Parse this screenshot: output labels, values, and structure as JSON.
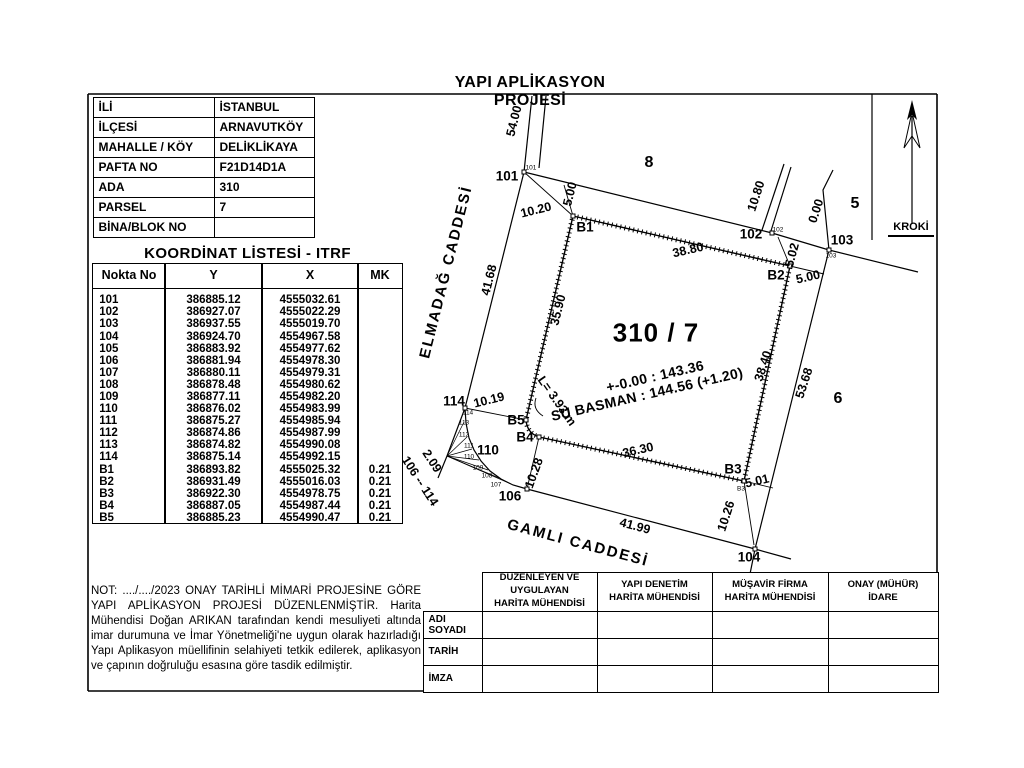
{
  "title": "YAPI APLİKASYON PROJESİ",
  "kroki_label": "KROKİ",
  "info_table": {
    "rows": [
      {
        "label": "İLİ",
        "value": "İSTANBUL"
      },
      {
        "label": "İLÇESİ",
        "value": "ARNAVUTKÖY"
      },
      {
        "label": "MAHALLE / KÖY",
        "value": "DELİKLİKAYA"
      },
      {
        "label": "PAFTA NO",
        "value": "F21D14D1A"
      },
      {
        "label": "ADA",
        "value": "310"
      },
      {
        "label": "PARSEL",
        "value": "7"
      },
      {
        "label": "BİNA/BLOK NO",
        "value": ""
      }
    ]
  },
  "coord_table": {
    "title": "KOORDİNAT LİSTESİ - ITRF",
    "headers": [
      "Nokta No",
      "Y",
      "X",
      "MK"
    ],
    "rows": [
      {
        "no": "101",
        "y": "386885.12",
        "x": "4555032.61",
        "mk": ""
      },
      {
        "no": "102",
        "y": "386927.07",
        "x": "4555022.29",
        "mk": ""
      },
      {
        "no": "103",
        "y": "386937.55",
        "x": "4555019.70",
        "mk": ""
      },
      {
        "no": "104",
        "y": "386924.70",
        "x": "4554967.58",
        "mk": ""
      },
      {
        "no": "105",
        "y": "386883.92",
        "x": "4554977.62",
        "mk": ""
      },
      {
        "no": "106",
        "y": "386881.94",
        "x": "4554978.30",
        "mk": ""
      },
      {
        "no": "107",
        "y": "386880.11",
        "x": "4554979.31",
        "mk": ""
      },
      {
        "no": "108",
        "y": "386878.48",
        "x": "4554980.62",
        "mk": ""
      },
      {
        "no": "109",
        "y": "386877.11",
        "x": "4554982.20",
        "mk": ""
      },
      {
        "no": "110",
        "y": "386876.02",
        "x": "4554983.99",
        "mk": ""
      },
      {
        "no": "111",
        "y": "386875.27",
        "x": "4554985.94",
        "mk": ""
      },
      {
        "no": "112",
        "y": "386874.86",
        "x": "4554987.99",
        "mk": ""
      },
      {
        "no": "113",
        "y": "386874.82",
        "x": "4554990.08",
        "mk": ""
      },
      {
        "no": "114",
        "y": "386875.14",
        "x": "4554992.15",
        "mk": ""
      },
      {
        "no": "B1",
        "y": "386893.82",
        "x": "4555025.32",
        "mk": "0.21"
      },
      {
        "no": "B2",
        "y": "386931.49",
        "x": "4555016.03",
        "mk": "0.21"
      },
      {
        "no": "B3",
        "y": "386922.30",
        "x": "4554978.75",
        "mk": "0.21"
      },
      {
        "no": "B4",
        "y": "386887.05",
        "x": "4554987.44",
        "mk": "0.21"
      },
      {
        "no": "B5",
        "y": "386885.23",
        "x": "4554990.47",
        "mk": "0.21"
      }
    ]
  },
  "note": "NOT: ..../..../2023 ONAY TARİHLİ MİMARİ PROJESİNE GÖRE YAPI APLİKASYON PROJESİ DÜZENLENMİŞTİR. Harita Mühendisi Doğan ARIKAN tarafından kendi mesuliyeti altında imar durumuna ve İmar Yönetmeliği'ne uygun olarak hazırladığı Yapı Aplikasyon müellifinin selahiyeti tetkik edilerek, aplikasyon ve çapının doğruluğu esasına göre tasdik edilmiştir.",
  "signature_table": {
    "column_headers": [
      "DÜZENLEYEN VE\nUYGULAYAN\nHARİTA MÜHENDİSİ",
      "YAPI DENETİM\nHARİTA MÜHENDİSİ",
      "MÜŞAVİR FİRMA\nHARİTA MÜHENDİSİ",
      "ONAY (MÜHÜR)\nİDARE"
    ],
    "row_labels": [
      "ADI SOYADI",
      "TARİH",
      "İMZA"
    ]
  },
  "drawing": {
    "parcel_number": "310 / 7",
    "elevation_note": "+-0.00 : 143.36",
    "basement_note": "SU BASMAN : 144.56 (+1.20)",
    "streets": [
      "ELMADAĞ CADDESİ",
      "GAMLI CADDESİ"
    ],
    "neighbor_parcels": [
      "8",
      "5",
      "6"
    ],
    "labels": [
      {
        "name": "street-elmadag",
        "text": "ELMADAĞ CADDESİ",
        "x": 446,
        "y": 272,
        "rot": -76,
        "cls": "street"
      },
      {
        "name": "street-gamli",
        "text": "GAMLI CADDESİ",
        "x": 578,
        "y": 543,
        "rot": 15,
        "cls": "street"
      },
      {
        "name": "parcel-title",
        "text": "310 / 7",
        "x": 656,
        "y": 333,
        "rot": 0,
        "cls": "parcel"
      },
      {
        "name": "elevation-note",
        "text": "+-0.00 : 143.36",
        "x": 655,
        "y": 376,
        "rot": -13,
        "cls": "note-big"
      },
      {
        "name": "basement-note",
        "text": "SU BASMAN : 144.56 (+1.20)",
        "x": 647,
        "y": 394,
        "rot": -13,
        "cls": "note-big"
      },
      {
        "name": "neighbor-parcel-8",
        "text": "8",
        "x": 649,
        "y": 163,
        "rot": 0,
        "cls": "neighbor"
      },
      {
        "name": "neighbor-parcel-5",
        "text": "5",
        "x": 855,
        "y": 204,
        "rot": 0,
        "cls": "neighbor"
      },
      {
        "name": "neighbor-parcel-6",
        "text": "6",
        "x": 838,
        "y": 399,
        "rot": 0,
        "cls": "neighbor"
      },
      {
        "name": "point-101",
        "text": "101",
        "x": 507,
        "y": 176,
        "rot": 0,
        "cls": "pt"
      },
      {
        "name": "point-102",
        "text": "102",
        "x": 751,
        "y": 234,
        "rot": 0,
        "cls": "pt"
      },
      {
        "name": "point-103",
        "text": "103",
        "x": 842,
        "y": 240,
        "rot": 0,
        "cls": "pt"
      },
      {
        "name": "point-104",
        "text": "104",
        "x": 749,
        "y": 557,
        "rot": 0,
        "cls": "pt"
      },
      {
        "name": "point-106",
        "text": "106",
        "x": 510,
        "y": 496,
        "rot": 0,
        "cls": "pt"
      },
      {
        "name": "point-110",
        "text": "110",
        "x": 488,
        "y": 450,
        "rot": 0,
        "cls": "pt"
      },
      {
        "name": "point-114",
        "text": "114",
        "x": 454,
        "y": 401,
        "rot": 0,
        "cls": "pt"
      },
      {
        "name": "point-B1",
        "text": "B1",
        "x": 585,
        "y": 227,
        "rot": 0,
        "cls": "pt"
      },
      {
        "name": "point-B2",
        "text": "B2",
        "x": 776,
        "y": 275,
        "rot": 0,
        "cls": "pt"
      },
      {
        "name": "point-B3",
        "text": "B3",
        "x": 733,
        "y": 469,
        "rot": 0,
        "cls": "pt"
      },
      {
        "name": "point-B4",
        "text": "B4",
        "x": 525,
        "y": 437,
        "rot": 0,
        "cls": "pt"
      },
      {
        "name": "point-B5",
        "text": "B5",
        "x": 516,
        "y": 420,
        "rot": 0,
        "cls": "pt"
      },
      {
        "name": "dim-54-00",
        "text": "54.00",
        "x": 514,
        "y": 121,
        "rot": -76,
        "cls": "dim"
      },
      {
        "name": "dim-10-20",
        "text": "10.20",
        "x": 536,
        "y": 210,
        "rot": -14,
        "cls": "dim"
      },
      {
        "name": "dim-5-00-b1",
        "text": "5.00",
        "x": 570,
        "y": 194,
        "rot": -76,
        "cls": "dim"
      },
      {
        "name": "dim-38-80",
        "text": "38.80",
        "x": 688,
        "y": 250,
        "rot": -13,
        "cls": "dim"
      },
      {
        "name": "dim-10-80",
        "text": "10.80",
        "x": 756,
        "y": 196,
        "rot": -72,
        "cls": "dim"
      },
      {
        "name": "dim-0-00",
        "text": "0.00",
        "x": 816,
        "y": 211,
        "rot": -72,
        "cls": "dim"
      },
      {
        "name": "dim-5-02",
        "text": "5.02",
        "x": 792,
        "y": 255,
        "rot": -75,
        "cls": "dim"
      },
      {
        "name": "dim-5-00-b2",
        "text": "5.00",
        "x": 808,
        "y": 277,
        "rot": -13,
        "cls": "dim"
      },
      {
        "name": "dim-41-68",
        "text": "41.68",
        "x": 489,
        "y": 280,
        "rot": -76,
        "cls": "dim"
      },
      {
        "name": "dim-35-90",
        "text": "35.90",
        "x": 558,
        "y": 310,
        "rot": -76,
        "cls": "dim"
      },
      {
        "name": "dim-38-40",
        "text": "38.40",
        "x": 763,
        "y": 366,
        "rot": -72,
        "cls": "dim"
      },
      {
        "name": "dim-53-68",
        "text": "53.68",
        "x": 804,
        "y": 383,
        "rot": -72,
        "cls": "dim"
      },
      {
        "name": "dim-10-19",
        "text": "10.19",
        "x": 489,
        "y": 400,
        "rot": -14,
        "cls": "dim"
      },
      {
        "name": "dim-36-30",
        "text": "36.30",
        "x": 638,
        "y": 450,
        "rot": -13,
        "cls": "dim"
      },
      {
        "name": "dim-5-01",
        "text": "5.01",
        "x": 757,
        "y": 481,
        "rot": -13,
        "cls": "dim"
      },
      {
        "name": "dim-10-26",
        "text": "10.26",
        "x": 726,
        "y": 516,
        "rot": -72,
        "cls": "dim"
      },
      {
        "name": "dim-10-28",
        "text": "10.28",
        "x": 534,
        "y": 473,
        "rot": -70,
        "cls": "dim"
      },
      {
        "name": "dim-41-99",
        "text": "41.99",
        "x": 635,
        "y": 526,
        "rot": 15,
        "cls": "dim"
      },
      {
        "name": "dim-2-09",
        "text": "2.09",
        "x": 432,
        "y": 461,
        "rot": 57,
        "cls": "dim"
      },
      {
        "name": "dim-range-106-114",
        "text": "106 -- 114",
        "x": 420,
        "y": 481,
        "rot": 57,
        "cls": "dim"
      },
      {
        "name": "dim-arc-length",
        "text": "L= 3.93 m",
        "x": 557,
        "y": 401,
        "rot": 55,
        "cls": "dim"
      },
      {
        "name": "tiny-114",
        "text": "114",
        "x": 468,
        "y": 413,
        "rot": 0,
        "cls": "tiny"
      },
      {
        "name": "tiny-113",
        "text": "113",
        "x": 464,
        "y": 423,
        "rot": 0,
        "cls": "tiny"
      },
      {
        "name": "tiny-112",
        "text": "112",
        "x": 464,
        "y": 435,
        "rot": 0,
        "cls": "tiny"
      },
      {
        "name": "tiny-111",
        "text": "111",
        "x": 469,
        "y": 446,
        "rot": 0,
        "cls": "tiny"
      },
      {
        "name": "tiny-110",
        "text": "110",
        "x": 469,
        "y": 457,
        "rot": 0,
        "cls": "tiny"
      },
      {
        "name": "tiny-109",
        "text": "109",
        "x": 478,
        "y": 468,
        "rot": 0,
        "cls": "tiny"
      },
      {
        "name": "tiny-108",
        "text": "108",
        "x": 487,
        "y": 476,
        "rot": 0,
        "cls": "tiny"
      },
      {
        "name": "tiny-107",
        "text": "107",
        "x": 496,
        "y": 485,
        "rot": 0,
        "cls": "tiny"
      },
      {
        "name": "tiny-101",
        "text": "101",
        "x": 531,
        "y": 168,
        "rot": 0,
        "cls": "tiny"
      },
      {
        "name": "tiny-102",
        "text": "102",
        "x": 778,
        "y": 230,
        "rot": 0,
        "cls": "tiny"
      },
      {
        "name": "tiny-103",
        "text": "103",
        "x": 831,
        "y": 256,
        "rot": 0,
        "cls": "tiny"
      },
      {
        "name": "tiny-b3",
        "text": "B3",
        "x": 741,
        "y": 489,
        "rot": 0,
        "cls": "tiny"
      }
    ]
  }
}
